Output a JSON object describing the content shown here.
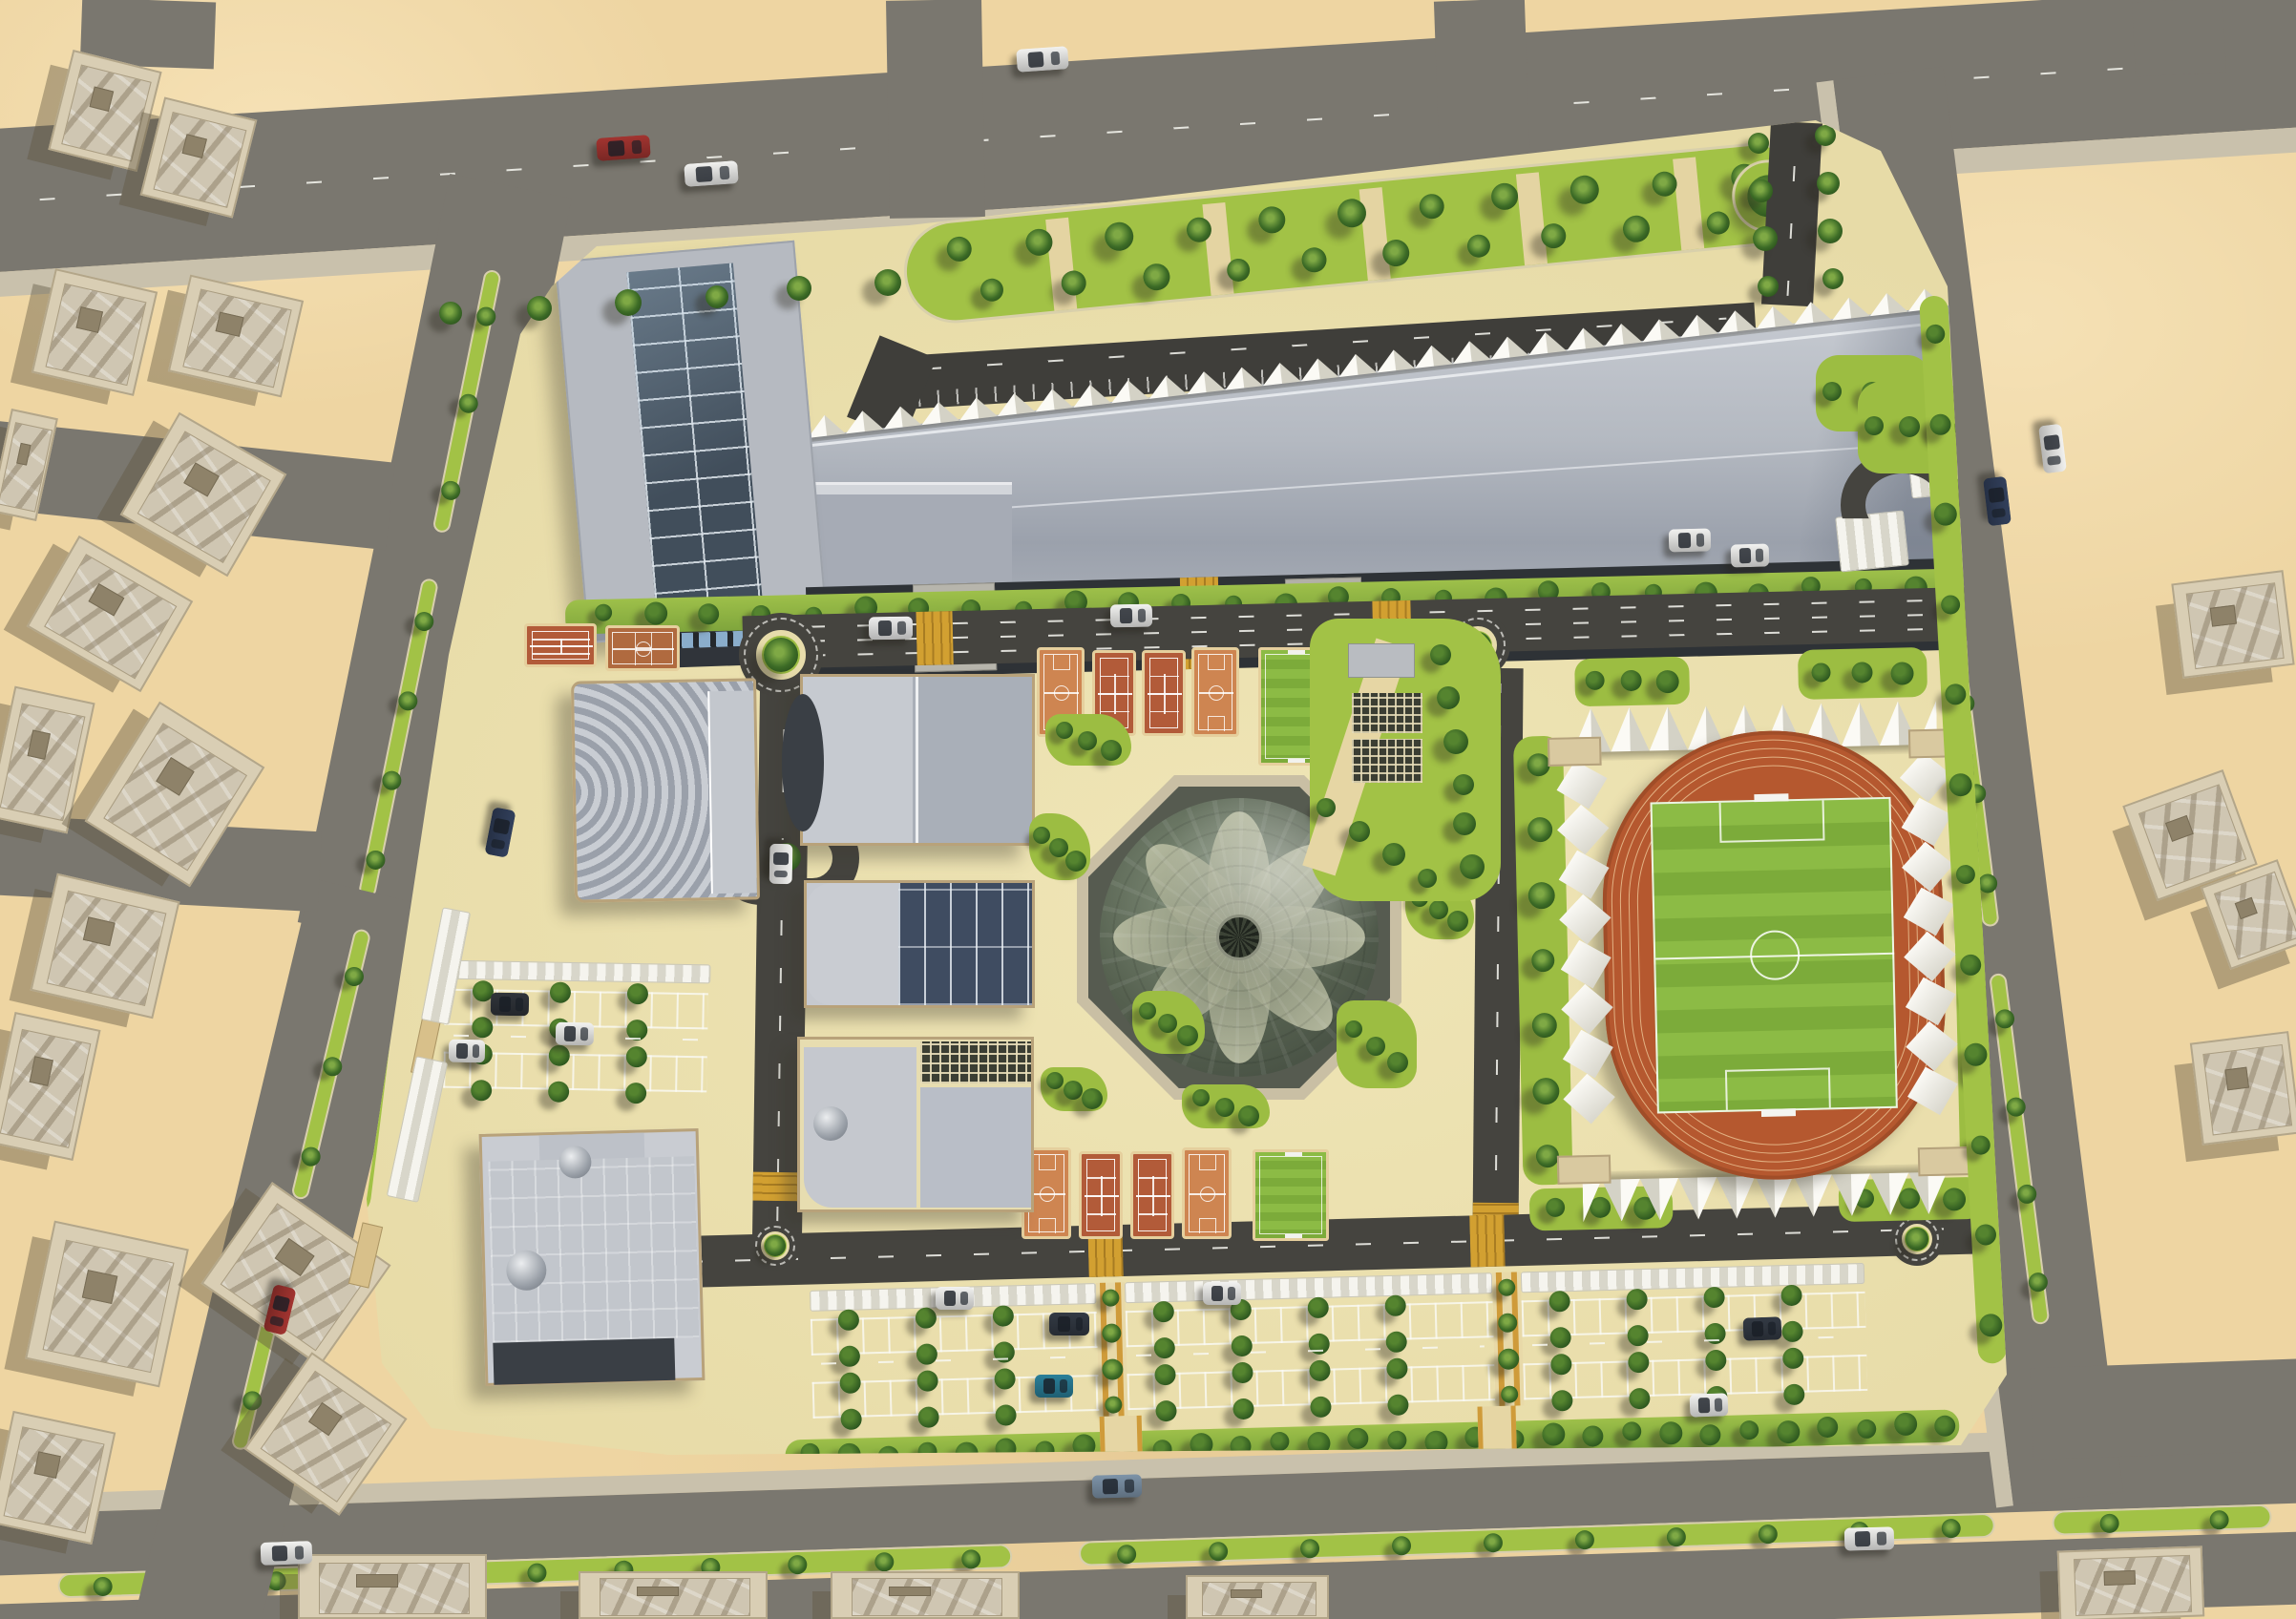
{
  "scene": {
    "title": "Sports city campus master plan - aerial render",
    "environment": "desert district",
    "view": "top-down 3d architectural rendering",
    "visible_text": "none"
  },
  "palette": {
    "sand": "#eed5a2",
    "city_asphalt": "#7a776f",
    "campus_asphalt": "#45443f",
    "plaza_cream": "#eadfae",
    "walkway_tan": "#e4d4a2",
    "grass_lime": "#a2c246",
    "tree_green": "#35621f",
    "hedge_green": "#89b03c",
    "roof_light_gray": "#bdc1c8",
    "roof_mid_gray": "#a2a8b1",
    "roof_navy_panel": "#3f4c61",
    "glass_blue": "#43505d",
    "facade_dark": "#2e3236",
    "window_blue": "#8aadcb",
    "court_basketball": "#ce8551",
    "court_tennis": "#b25b39",
    "running_track": "#b5582f",
    "track_lane_line": "#e2b183",
    "pitch_green_a": "#8cbb45",
    "pitch_green_b": "#7cab3a",
    "canopy_white": "#f2f1ec",
    "crosswalk_yellow": "#d2a031",
    "dome_glass_dark": "#4d584c",
    "dome_petal": "#aeb29b",
    "sidewalk": "#c9c1ac",
    "district_building": "#d9ceb4",
    "district_roof": "#cfc6b2"
  },
  "campus": {
    "main_building": {
      "id": "main-sports-hall",
      "roof": "corrugated gray with sawtooth north edge",
      "west_wing": "glass skylight grid roof",
      "south_facade": "dark band with two blue window strips and entrance canopies"
    },
    "buildings": [
      {
        "id": "auditorium-fan-roof",
        "roof": "curved ribbed"
      },
      {
        "id": "indoor-hall-west",
        "roof": "two gray slabs, curved west facade"
      },
      {
        "id": "training-hall-mid",
        "roof": "light slab + navy glass panels"
      },
      {
        "id": "hall-with-pergola",
        "roof": "gray slabs with trellis court and silver dome"
      },
      {
        "id": "southwest-hall",
        "roof": "paneled gray with two silver domes"
      }
    ],
    "central_dome": {
      "id": "glass-petal-dome",
      "base": "octagonal",
      "petals": 8
    },
    "stadium": {
      "id": "athletics-stadium",
      "track_lanes": 8,
      "field": "striped football pitch",
      "side_canopies_per_side": 8,
      "end_canopies": "white sawtooth shades north and south"
    },
    "courts": {
      "west_pair": [
        "tennis",
        "basketball"
      ],
      "north_row": [
        "basketball",
        "tennis",
        "tennis",
        "basketball",
        "training-pitch"
      ],
      "south_row": [
        "basketball",
        "tennis",
        "tennis",
        "basketball",
        "training-pitch"
      ]
    },
    "parking": {
      "south_lots": 3,
      "west_lot": 1,
      "northeast_shade_canopies": 2,
      "features": [
        "white shade canopies",
        "tree islands",
        "marked stalls",
        "yellow crosswalk pavers"
      ]
    },
    "roundabouts": 4,
    "landscape": {
      "north_garden": "palm grid wedge with tan walkways",
      "pergola_garden": "dark trellis blocks in lime garden",
      "hedge_rows": "along facade and south boundary",
      "palm_lined_medians": true
    }
  },
  "surroundings": {
    "district_buildings": 22,
    "roads": [
      "north arterial",
      "south arterial with palm median",
      "west diagonal road with palm median",
      "east arterial with palm median",
      "edge stubs"
    ],
    "vehicles_total": 24
  }
}
